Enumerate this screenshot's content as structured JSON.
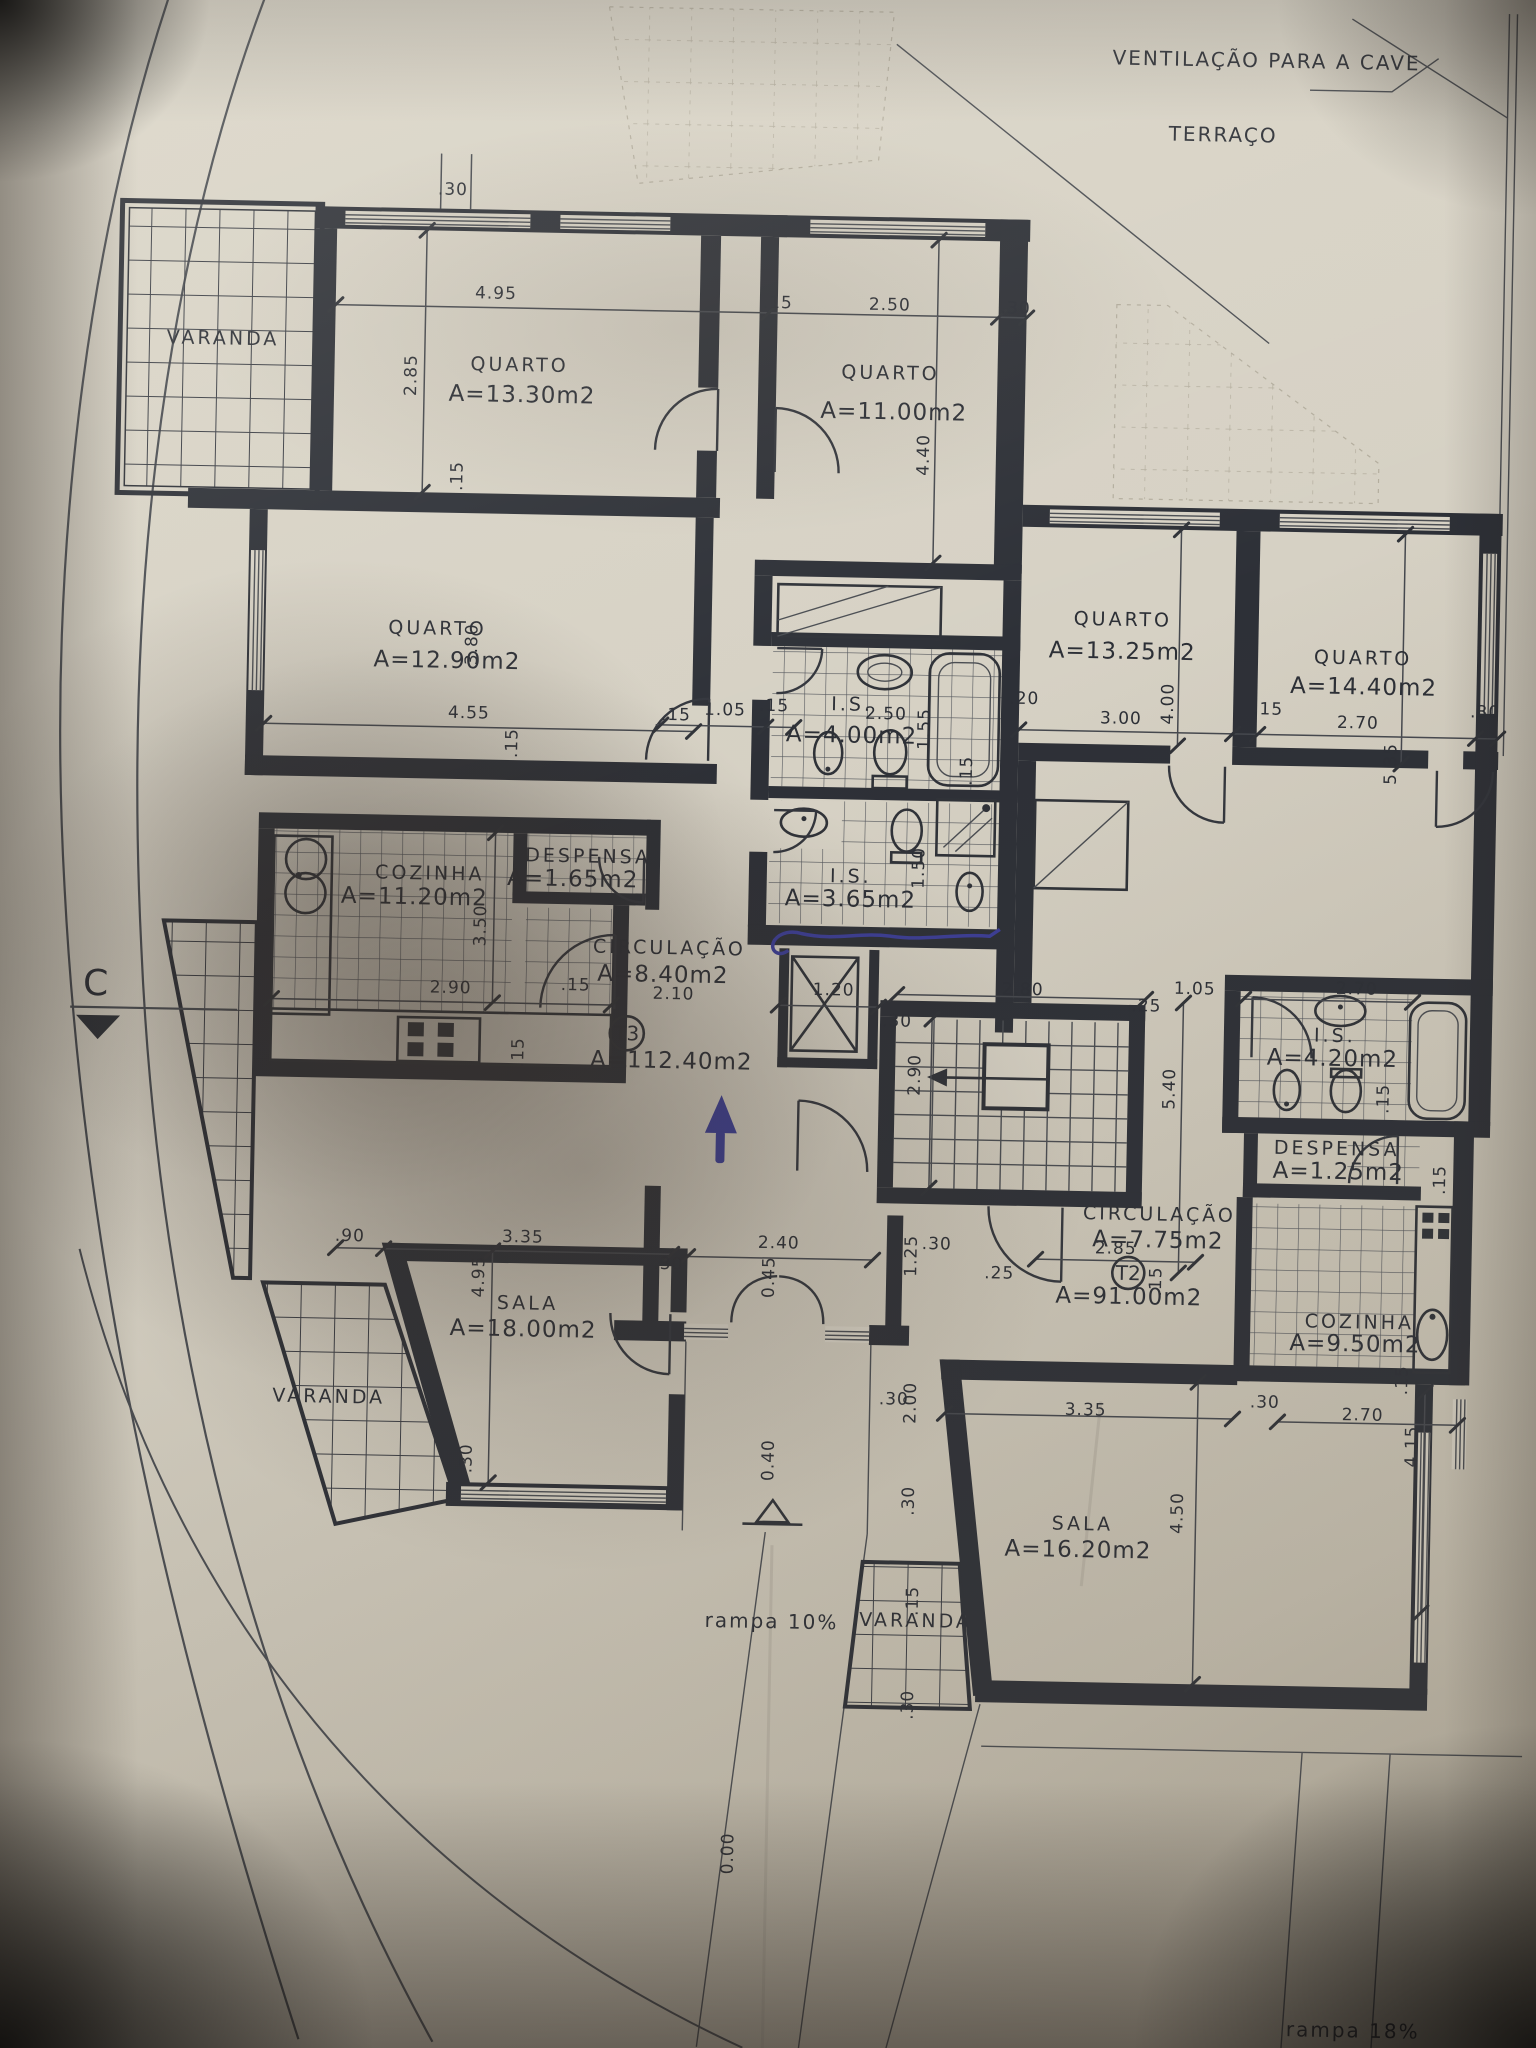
{
  "site": {
    "ventilation": "VENTILAÇÃO PARA A CAVE",
    "terrace": "TERRAÇO",
    "ramp_left": "rampa 10%",
    "ramp_right": "rampa 18%",
    "level_zero": "0.00",
    "section": "C"
  },
  "units": {
    "t3": {
      "tag": "T3",
      "area": "A=112.40m2"
    },
    "t2": {
      "tag": "T2",
      "area": "A=91.00m2"
    }
  },
  "rooms": {
    "varanda_tl": {
      "name": "VARANDA"
    },
    "q1": {
      "name": "QUARTO",
      "area": "A=13.30m2"
    },
    "q2": {
      "name": "QUARTO",
      "area": "A=11.00m2"
    },
    "q3": {
      "name": "QUARTO",
      "area": "A=12.90m2"
    },
    "q4": {
      "name": "QUARTO",
      "area": "A=13.25m2"
    },
    "q5": {
      "name": "QUARTO",
      "area": "A=14.40m2"
    },
    "cozinha_t3": {
      "name": "COZINHA",
      "area": "A=11.20m2"
    },
    "despensa_t3": {
      "name": "DESPENSA",
      "area": "A=1.65m2"
    },
    "circulacao_t3": {
      "name": "CIRCULAÇÃO",
      "area": "A=8.40m2"
    },
    "is_a": {
      "name": "I.S.",
      "area": "A=4.00m2"
    },
    "is_b": {
      "name": "I.S.",
      "area": "A=3.65m2"
    },
    "sala_t3": {
      "name": "SALA",
      "area": "A=18.00m2"
    },
    "varanda_bl": {
      "name": "VARANDA"
    },
    "is_t2": {
      "name": "I.S.",
      "area": "A=4.20m2"
    },
    "despensa_t2": {
      "name": "DESPENSA",
      "area": "A=1.25m2"
    },
    "circulacao_t2": {
      "name": "CIRCULAÇÃO",
      "area": "A=7.75m2"
    },
    "cozinha_t2": {
      "name": "COZINHA",
      "area": "A=9.50m2"
    },
    "sala_t2": {
      "name": "SALA",
      "area": "A=16.20m2"
    },
    "varanda_b": {
      "name": "VARANDA"
    }
  },
  "dims": {
    "top30": ".30",
    "q1w": "4.95",
    "q1h": "2.85",
    "q1s": ".15",
    "q2a": ".15",
    "q2w": "2.50",
    "q2b": ".30",
    "q2h": "4.40",
    "q3h": "3.80",
    "q3w": "4.55",
    "q3s": ".15",
    "h15a": ".15",
    "h105": "1.05",
    "h15b": ".15",
    "isaw": "2.50",
    "isah": "1.55",
    "isa20": ".20",
    "isa15": ".15",
    "isbh": "1.50",
    "q4w": "3.00",
    "q4h": "4.00",
    "q4s": ".15",
    "q5w": "2.70",
    "q5b": ".30",
    "q5h": "5.35",
    "kw": "2.90",
    "kh": "3.50",
    "ks": ".15",
    "ks2": ".15",
    "c21": "2.10",
    "elev": "1.20",
    "stw": "2.80",
    "st30": ".30",
    "sth": "2.90",
    "st25": ".25",
    "st105": "1.05",
    "sth2": "5.40",
    "t2bw": "2.70",
    "t2b15": ".15",
    "t2d15": ".15",
    "c285": "2.85",
    "t215": ".15",
    "s190": ".90",
    "s1w": "3.35",
    "s1h": "4.95",
    "s130": ".30",
    "e30a": ".30",
    "e240": "2.40",
    "e045": "0.45",
    "e125": "1.25",
    "e30b": ".30",
    "e25": ".25",
    "e200": "2.00",
    "e30c": ".30",
    "e040": "0.40",
    "e30d": ".30",
    "s2w": "3.35",
    "s2h": "4.50",
    "k230": ".30",
    "k2w": "2.70",
    "k2h": "4.15",
    "k215": ".15",
    "v15": ".15",
    "v30": ".30"
  }
}
